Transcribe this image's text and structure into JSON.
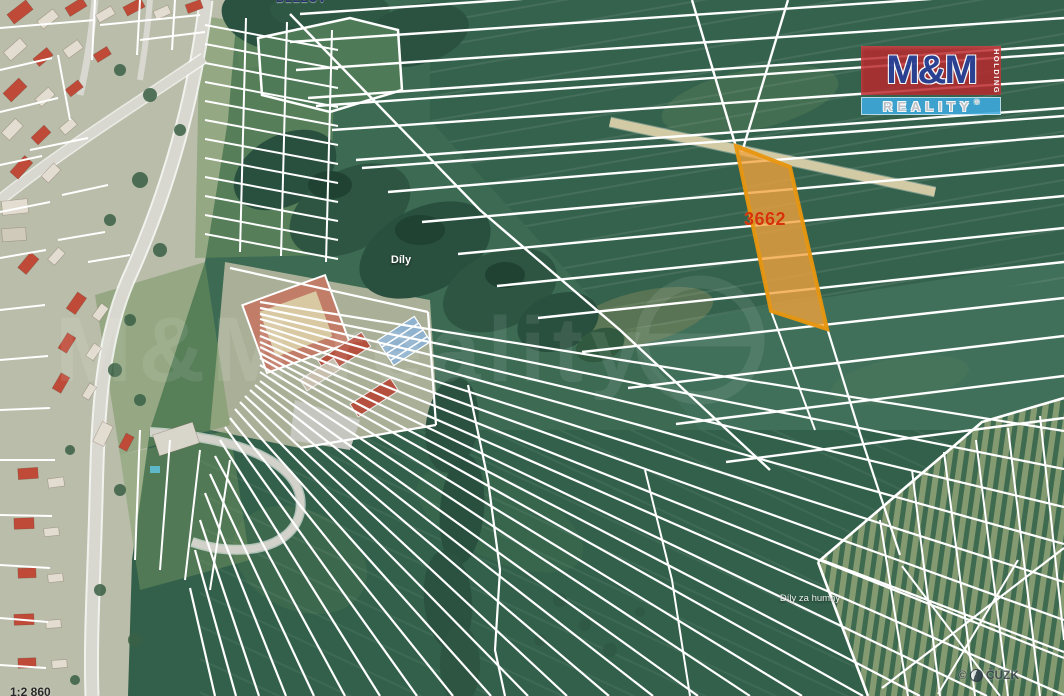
{
  "map": {
    "parcel": {
      "number": "3662"
    },
    "place_labels": {
      "top_clipped": "BLEŽOV",
      "field_center": "Díly",
      "field_bottom_right": "Díly za humny",
      "scale_clipped": "1:2 860"
    },
    "attribution": {
      "copyright": "©",
      "org": "ČÚZK"
    },
    "watermark_text": "M&M reality",
    "logo": {
      "title": "M&M",
      "line2": "REALITY",
      "side": "HOLDING",
      "registered": "®"
    },
    "colors": {
      "parcel_fill": "#F2A33C",
      "parcel_border": "#E8960F",
      "parcel_number": "#D6310E",
      "boundary_lines": "#FFFFFF",
      "logo_red": "#BE3038",
      "logo_blue": "#3EA9DC",
      "logo_navy": "#2A3F94",
      "field_green": "#3C6A53"
    }
  }
}
